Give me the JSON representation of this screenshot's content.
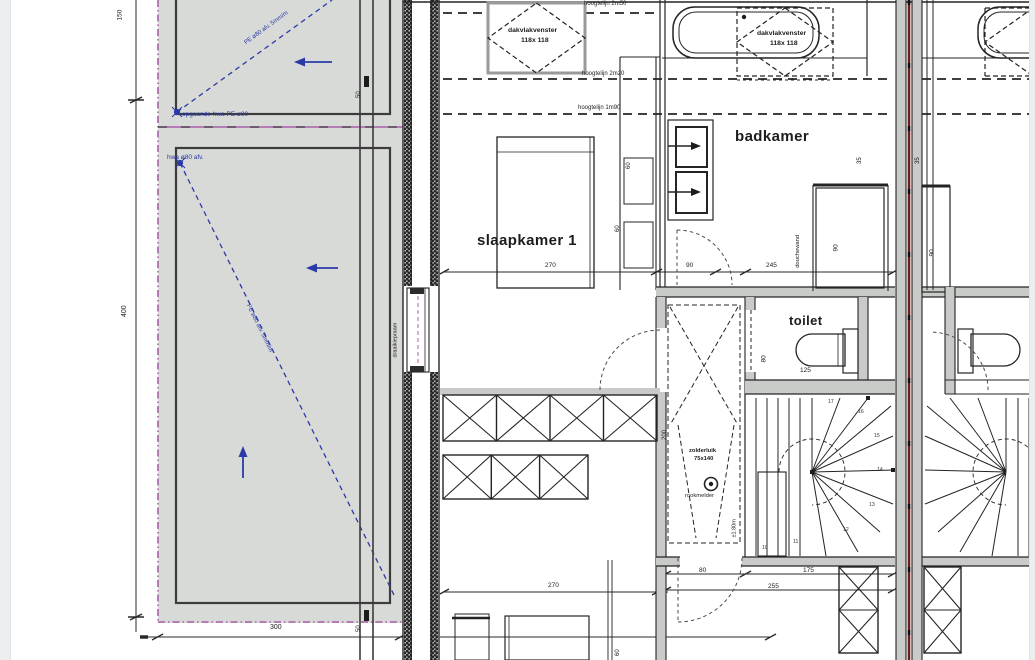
{
  "document": {
    "type": "architectural floor plan (verdieping)",
    "language": "nl"
  },
  "colors": {
    "annotation_blue": "#2b3aa8",
    "roof_edge_magenta": "#a85fa8",
    "party_wall_red": "#6a1c1c",
    "roof_fill": "#d8dad7",
    "wall_fill": "#c9cbc9",
    "line": "#242424",
    "page_edge": "#edeeef"
  },
  "rooms": [
    {
      "label": "slaapkamer 1"
    },
    {
      "label": "badkamer"
    },
    {
      "label": "toilet"
    }
  ],
  "symbols": [
    "roof-window",
    "bathtub",
    "washbasin",
    "shower",
    "toilet-bowl",
    "bed",
    "wardrobe",
    "winder-staircase",
    "smoke-detector",
    "attic-hatch",
    "door-swing",
    "rainwater-pipe",
    "dimension-line",
    "height-line"
  ],
  "labels": [
    {
      "name": "room-label-slaapkamer1",
      "text": "slaapkamer 1",
      "x": 477,
      "y": 233,
      "size": 15,
      "bold": true,
      "cls": "room"
    },
    {
      "name": "room-label-badkamer",
      "text": "badkamer",
      "x": 735,
      "y": 129,
      "size": 15,
      "bold": true,
      "cls": "room"
    },
    {
      "name": "room-label-toilet",
      "text": "toilet",
      "x": 789,
      "y": 314,
      "size": 13,
      "bold": true,
      "cls": "room"
    },
    {
      "name": "roofwindow-1-label-line1",
      "text": "dakvlakvenster",
      "x": 508,
      "y": 28,
      "size": 6.8,
      "bold": true
    },
    {
      "name": "roofwindow-1-label-line2",
      "text": "118x 118",
      "x": 521,
      "y": 38,
      "size": 6.8,
      "bold": true
    },
    {
      "name": "roofwindow-2-label-line1",
      "text": "dakvlakvenster",
      "x": 757,
      "y": 31,
      "size": 6.8,
      "bold": true
    },
    {
      "name": "roofwindow-2-label-line2",
      "text": "118x 118",
      "x": 770,
      "y": 41,
      "size": 6.8,
      "bold": true
    },
    {
      "name": "heightline-label-1",
      "text": "hoogtelijn 2m50",
      "x": 584,
      "y": 1,
      "size": 6
    },
    {
      "name": "heightline-label-2",
      "text": "hoogtelijn 2m20",
      "x": 582,
      "y": 71,
      "size": 6
    },
    {
      "name": "heightline-label-3",
      "text": "hoogtelijn 1m90",
      "x": 578,
      "y": 105,
      "size": 6
    },
    {
      "name": "roof-drain-note-1",
      "text": "opgaande hwa PE ø80",
      "x": 182,
      "y": 112,
      "size": 6.5,
      "color": "#2b3aa8"
    },
    {
      "name": "roof-drain-note-2",
      "text": "hwa ø80 afv.",
      "x": 167,
      "y": 155,
      "size": 6.5,
      "color": "#2b3aa8"
    },
    {
      "name": "roof-slope-note-top",
      "text": "PE ø80 afv. 5mm/m",
      "x": 247,
      "y": 40,
      "rot": -36,
      "size": 6,
      "color": "#2b3aa8"
    },
    {
      "name": "roof-slope-note-main",
      "text": "PE ø80 afv. 5mm/m",
      "x": 245,
      "y": 300,
      "rot": 64,
      "size": 6,
      "color": "#2b3aa8"
    },
    {
      "name": "dim-top-left",
      "text": "150",
      "x": 124,
      "y": 14,
      "rot": -90,
      "size": 6.5
    },
    {
      "name": "dim-left-height",
      "text": "400",
      "x": 128,
      "y": 310,
      "rot": -90,
      "size": 7
    },
    {
      "name": "dim-bottom-roof",
      "text": "300",
      "x": 270,
      "y": 624,
      "size": 7
    },
    {
      "name": "pipe-dim-top",
      "text": "50",
      "x": 362,
      "y": 92,
      "rot": -90,
      "size": 6
    },
    {
      "name": "pipe-dim-bottom",
      "text": "50",
      "x": 362,
      "y": 626,
      "rot": -90,
      "size": 6
    },
    {
      "name": "window-label-draaikiepraam",
      "text": "draaikiepraam",
      "x": 399,
      "y": 352,
      "rot": -90,
      "size": 5.5
    },
    {
      "name": "dim-slaapkamer-width",
      "text": "270",
      "x": 545,
      "y": 263,
      "size": 6.5
    },
    {
      "name": "dim-nightstand-a",
      "text": "60",
      "x": 632,
      "y": 163,
      "rot": -90,
      "size": 6
    },
    {
      "name": "dim-nightstand-b",
      "text": "60",
      "x": 621,
      "y": 226,
      "rot": -90,
      "size": 6
    },
    {
      "name": "dim-badkamer-door",
      "text": "90",
      "x": 686,
      "y": 263,
      "size": 6.5
    },
    {
      "name": "dim-badkamer-rest",
      "text": "245",
      "x": 766,
      "y": 263,
      "size": 6.5
    },
    {
      "name": "shower-label",
      "text": "douchewand",
      "x": 802,
      "y": 262,
      "rot": -90,
      "size": 5.8
    },
    {
      "name": "dim-shower-width",
      "text": "90",
      "x": 840,
      "y": 245,
      "rot": -90,
      "size": 6.5
    },
    {
      "name": "dim-shower-offset",
      "text": "35",
      "x": 863,
      "y": 158,
      "rot": -90,
      "size": 6
    },
    {
      "name": "dim-toilet-width",
      "text": "125",
      "x": 800,
      "y": 368,
      "size": 6.5
    },
    {
      "name": "dim-toilet-depth",
      "text": "80",
      "x": 768,
      "y": 356,
      "rot": -90,
      "size": 6.5
    },
    {
      "name": "attic-hatch-label-line1",
      "text": "zolderluik",
      "x": 689,
      "y": 449,
      "size": 5.8,
      "bold": true
    },
    {
      "name": "attic-hatch-label-line2",
      "text": "75x140",
      "x": 694,
      "y": 457,
      "size": 5.8,
      "bold": true
    },
    {
      "name": "smoke-detector-label",
      "text": "rookmelder",
      "x": 685,
      "y": 494,
      "size": 5.8
    },
    {
      "name": "dim-hall-depth",
      "text": "200",
      "x": 668,
      "y": 434,
      "rot": -90,
      "size": 6
    },
    {
      "name": "headroom-note",
      "text": "±1.80m",
      "x": 738,
      "y": 532,
      "rot": -90,
      "size": 5.5
    },
    {
      "name": "dim-bottom-room-width",
      "text": "270",
      "x": 548,
      "y": 583,
      "size": 6.5
    },
    {
      "name": "dim-hall-door",
      "text": "80",
      "x": 699,
      "y": 568,
      "size": 6.5
    },
    {
      "name": "dim-hall-rest",
      "text": "175",
      "x": 803,
      "y": 568,
      "size": 6.5
    },
    {
      "name": "dim-hall-total",
      "text": "255",
      "x": 768,
      "y": 584,
      "size": 6.5
    },
    {
      "name": "dim-bottom-cabinet",
      "text": "60",
      "x": 621,
      "y": 650,
      "rot": -90,
      "size": 6
    },
    {
      "name": "dim-neighbor-shower",
      "text": "90",
      "x": 936,
      "y": 250,
      "rot": -90,
      "size": 6.5
    },
    {
      "name": "dim-neighbor-offset",
      "text": "35",
      "x": 921,
      "y": 158,
      "rot": -90,
      "size": 6
    },
    {
      "name": "stair-tread-10",
      "text": "10",
      "x": 762,
      "y": 546,
      "size": 5.2,
      "color": "#333333"
    },
    {
      "name": "stair-tread-11",
      "text": "11",
      "x": 793,
      "y": 540,
      "size": 5.2,
      "color": "#333333"
    },
    {
      "name": "stair-tread-12",
      "text": "12",
      "x": 843,
      "y": 528,
      "size": 5.2,
      "color": "#333333"
    },
    {
      "name": "stair-tread-13",
      "text": "13",
      "x": 869,
      "y": 503,
      "size": 5.2,
      "color": "#333333"
    },
    {
      "name": "stair-tread-14",
      "text": "14",
      "x": 877,
      "y": 468,
      "size": 5.2,
      "color": "#333333"
    },
    {
      "name": "stair-tread-15",
      "text": "15",
      "x": 874,
      "y": 434,
      "size": 5.2,
      "color": "#333333"
    },
    {
      "name": "stair-tread-16",
      "text": "16",
      "x": 858,
      "y": 410,
      "size": 5.2,
      "color": "#333333"
    },
    {
      "name": "stair-tread-17",
      "text": "17",
      "x": 828,
      "y": 400,
      "size": 5.2,
      "color": "#333333"
    }
  ]
}
